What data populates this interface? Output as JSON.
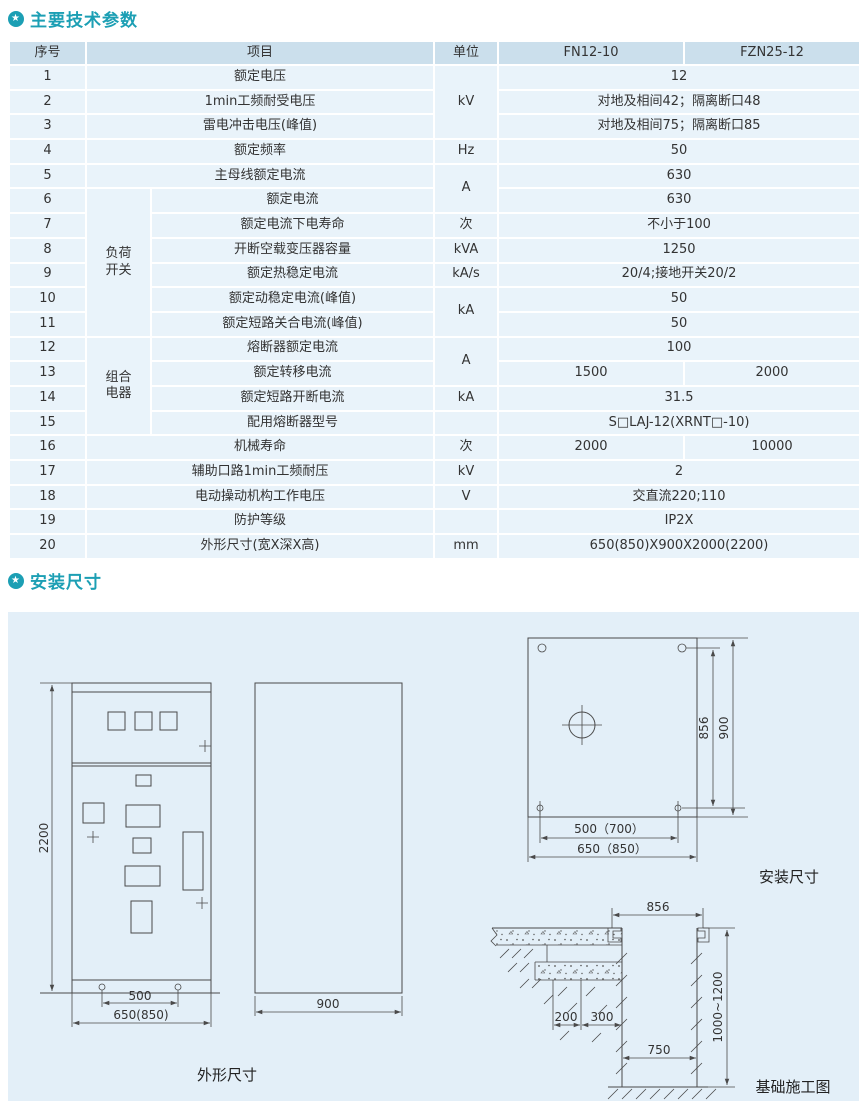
{
  "colors": {
    "accent": "#1c9fb4",
    "header_bg": "#cbdfec",
    "row_bg": "#e9f3fa",
    "panel_bg": "#e3eff8"
  },
  "sections": {
    "bullet_icon": "★",
    "params_title": "主要技术参数",
    "install_title": "安装尺寸"
  },
  "table": {
    "headers": {
      "no": "序号",
      "item": "项目",
      "unit": "单位",
      "model1": "FN12-10",
      "model2": "FZN25-12"
    },
    "groups": {
      "load_switch": [
        "负荷",
        "开关"
      ],
      "combo": [
        "组合",
        "电器"
      ]
    },
    "rows": [
      {
        "no": "1",
        "item": "额定电压",
        "unit": "kV",
        "value": "12"
      },
      {
        "no": "2",
        "item": "1min工频耐受电压",
        "value": "对地及相间42；隔离断口48"
      },
      {
        "no": "3",
        "item": "雷电冲击电压(峰值)",
        "value": "对地及相间75；隔离断口85"
      },
      {
        "no": "4",
        "item": "额定频率",
        "unit": "Hz",
        "value": "50"
      },
      {
        "no": "5",
        "item": "主母线额定电流",
        "unit": "A",
        "value": "630"
      },
      {
        "no": "6",
        "item": "额定电流",
        "value": "630"
      },
      {
        "no": "7",
        "item": "额定电流下电寿命",
        "unit": "次",
        "value": "不小于100"
      },
      {
        "no": "8",
        "item": "开断空载变压器容量",
        "unit": "kVA",
        "value": "1250"
      },
      {
        "no": "9",
        "item": "额定热稳定电流",
        "unit": "kA/s",
        "value": "20/4;接地开关20/2"
      },
      {
        "no": "10",
        "item": "额定动稳定电流(峰值)",
        "unit": "kA",
        "value": "50"
      },
      {
        "no": "11",
        "item": "额定短路关合电流(峰值)",
        "value": "50"
      },
      {
        "no": "12",
        "item": "熔断器额定电流",
        "unit": "A",
        "value": "100"
      },
      {
        "no": "13",
        "item": "额定转移电流",
        "value_fn": "1500",
        "value_fzn": "2000"
      },
      {
        "no": "14",
        "item": "额定短路开断电流",
        "unit": "kA",
        "value": "31.5"
      },
      {
        "no": "15",
        "item": "配用熔断器型号",
        "unit": "",
        "value": "S□LAJ-12(XRNT□-10)"
      },
      {
        "no": "16",
        "item": "机械寿命",
        "unit": "次",
        "value_fn": "2000",
        "value_fzn": "10000"
      },
      {
        "no": "17",
        "item": "辅助口路1min工频耐压",
        "unit": "kV",
        "value": "2"
      },
      {
        "no": "18",
        "item": "电动操动机构工作电压",
        "unit": "V",
        "value": "交直流220;110"
      },
      {
        "no": "19",
        "item": "防护等级",
        "unit": "",
        "value": "IP2X"
      },
      {
        "no": "20",
        "item": "外形尺寸(宽X深X高)",
        "unit": "mm",
        "value": "650(850)X900X2000(2200)"
      }
    ]
  },
  "diagrams": {
    "outline": {
      "dim_height": "2200",
      "dim_holes": "500",
      "dim_width": "650(850)",
      "dim_depth": "900",
      "caption": "外形尺寸"
    },
    "install": {
      "dim_inner": "856",
      "dim_outer": "900",
      "dim_holes": "500（700）",
      "dim_width": "650（850）",
      "caption": "安装尺寸"
    },
    "foundation": {
      "dim_top": "856",
      "dim_a": "200",
      "dim_b": "300",
      "dim_pit": "750",
      "dim_depth": "1000~1200",
      "caption": "基础施工图"
    }
  }
}
